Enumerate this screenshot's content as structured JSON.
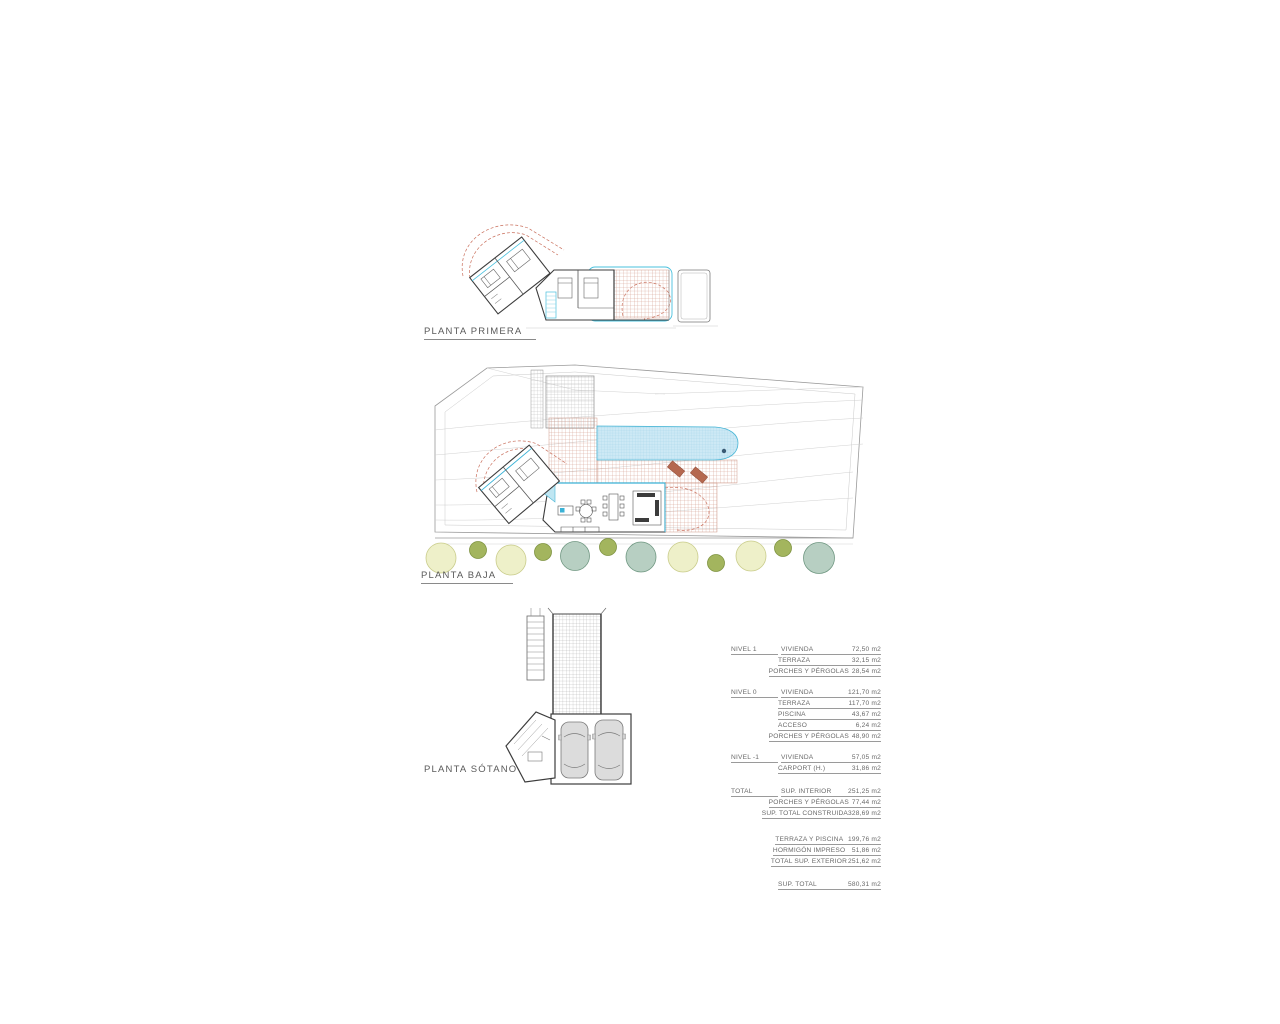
{
  "plans": {
    "primera": {
      "label": "PLANTA PRIMERA"
    },
    "baja": {
      "label": "PLANTA BAJA"
    },
    "sotano": {
      "label": "PLANTA SÓTANO"
    }
  },
  "area_table": {
    "unit": "m2",
    "rows": [
      {
        "level": "NIVEL 1",
        "label": "VIVIENDA",
        "value": "72,50 m2"
      },
      {
        "level": "",
        "label": "TERRAZA",
        "value": "32,15 m2"
      },
      {
        "level": "",
        "label": "PORCHES Y PÉRGOLAS",
        "value": "28,54 m2"
      },
      {
        "level": "NIVEL 0",
        "label": "VIVIENDA",
        "value": "121,70 m2"
      },
      {
        "level": "",
        "label": "TERRAZA",
        "value": "117,70 m2"
      },
      {
        "level": "",
        "label": "PISCINA",
        "value": "43,67 m2"
      },
      {
        "level": "",
        "label": "ACCESO",
        "value": "6,24 m2"
      },
      {
        "level": "",
        "label": "PORCHES Y PÉRGOLAS",
        "value": "48,90 m2"
      },
      {
        "level": "NIVEL -1",
        "label": "VIVIENDA",
        "value": "57,05 m2"
      },
      {
        "level": "",
        "label": "CARPORT (H.)",
        "value": "31,86 m2"
      },
      {
        "level": "TOTAL",
        "label": "SUP. INTERIOR",
        "value": "251,25 m2"
      },
      {
        "level": "",
        "label": "PORCHES Y PÉRGOLAS",
        "value": "77,44 m2"
      },
      {
        "level": "",
        "label": "SUP. TOTAL CONSTRUIDA",
        "value": "328,69 m2"
      },
      {
        "level": "",
        "label": "TERRAZA Y PISCINA",
        "value": "199,76 m2"
      },
      {
        "level": "",
        "label": "HORMIGÓN IMPRESO",
        "value": "51,86 m2"
      },
      {
        "level": "",
        "label": "TOTAL SUP. EXTERIOR",
        "value": "251,62 m2"
      },
      {
        "level": "",
        "label": "SUP. TOTAL",
        "value": "580,31 m2"
      }
    ]
  },
  "colors": {
    "paper": "#ffffff",
    "line_gray": "#9a9a9a",
    "wall_dark": "#3c3c3c",
    "red_hatch": "#cf8d7c",
    "red_dashed": "#c96f5c",
    "cyan_accent": "#3ab2d6",
    "pool_fill": "#cde9f5",
    "pool_grid": "#9ed2e6",
    "tree_pale": "#eef0c9",
    "tree_olive": "#a3b55e",
    "tree_sage": "#b7cfc2",
    "lounger": "#b5684f",
    "car_body": "#dcdcdc"
  }
}
